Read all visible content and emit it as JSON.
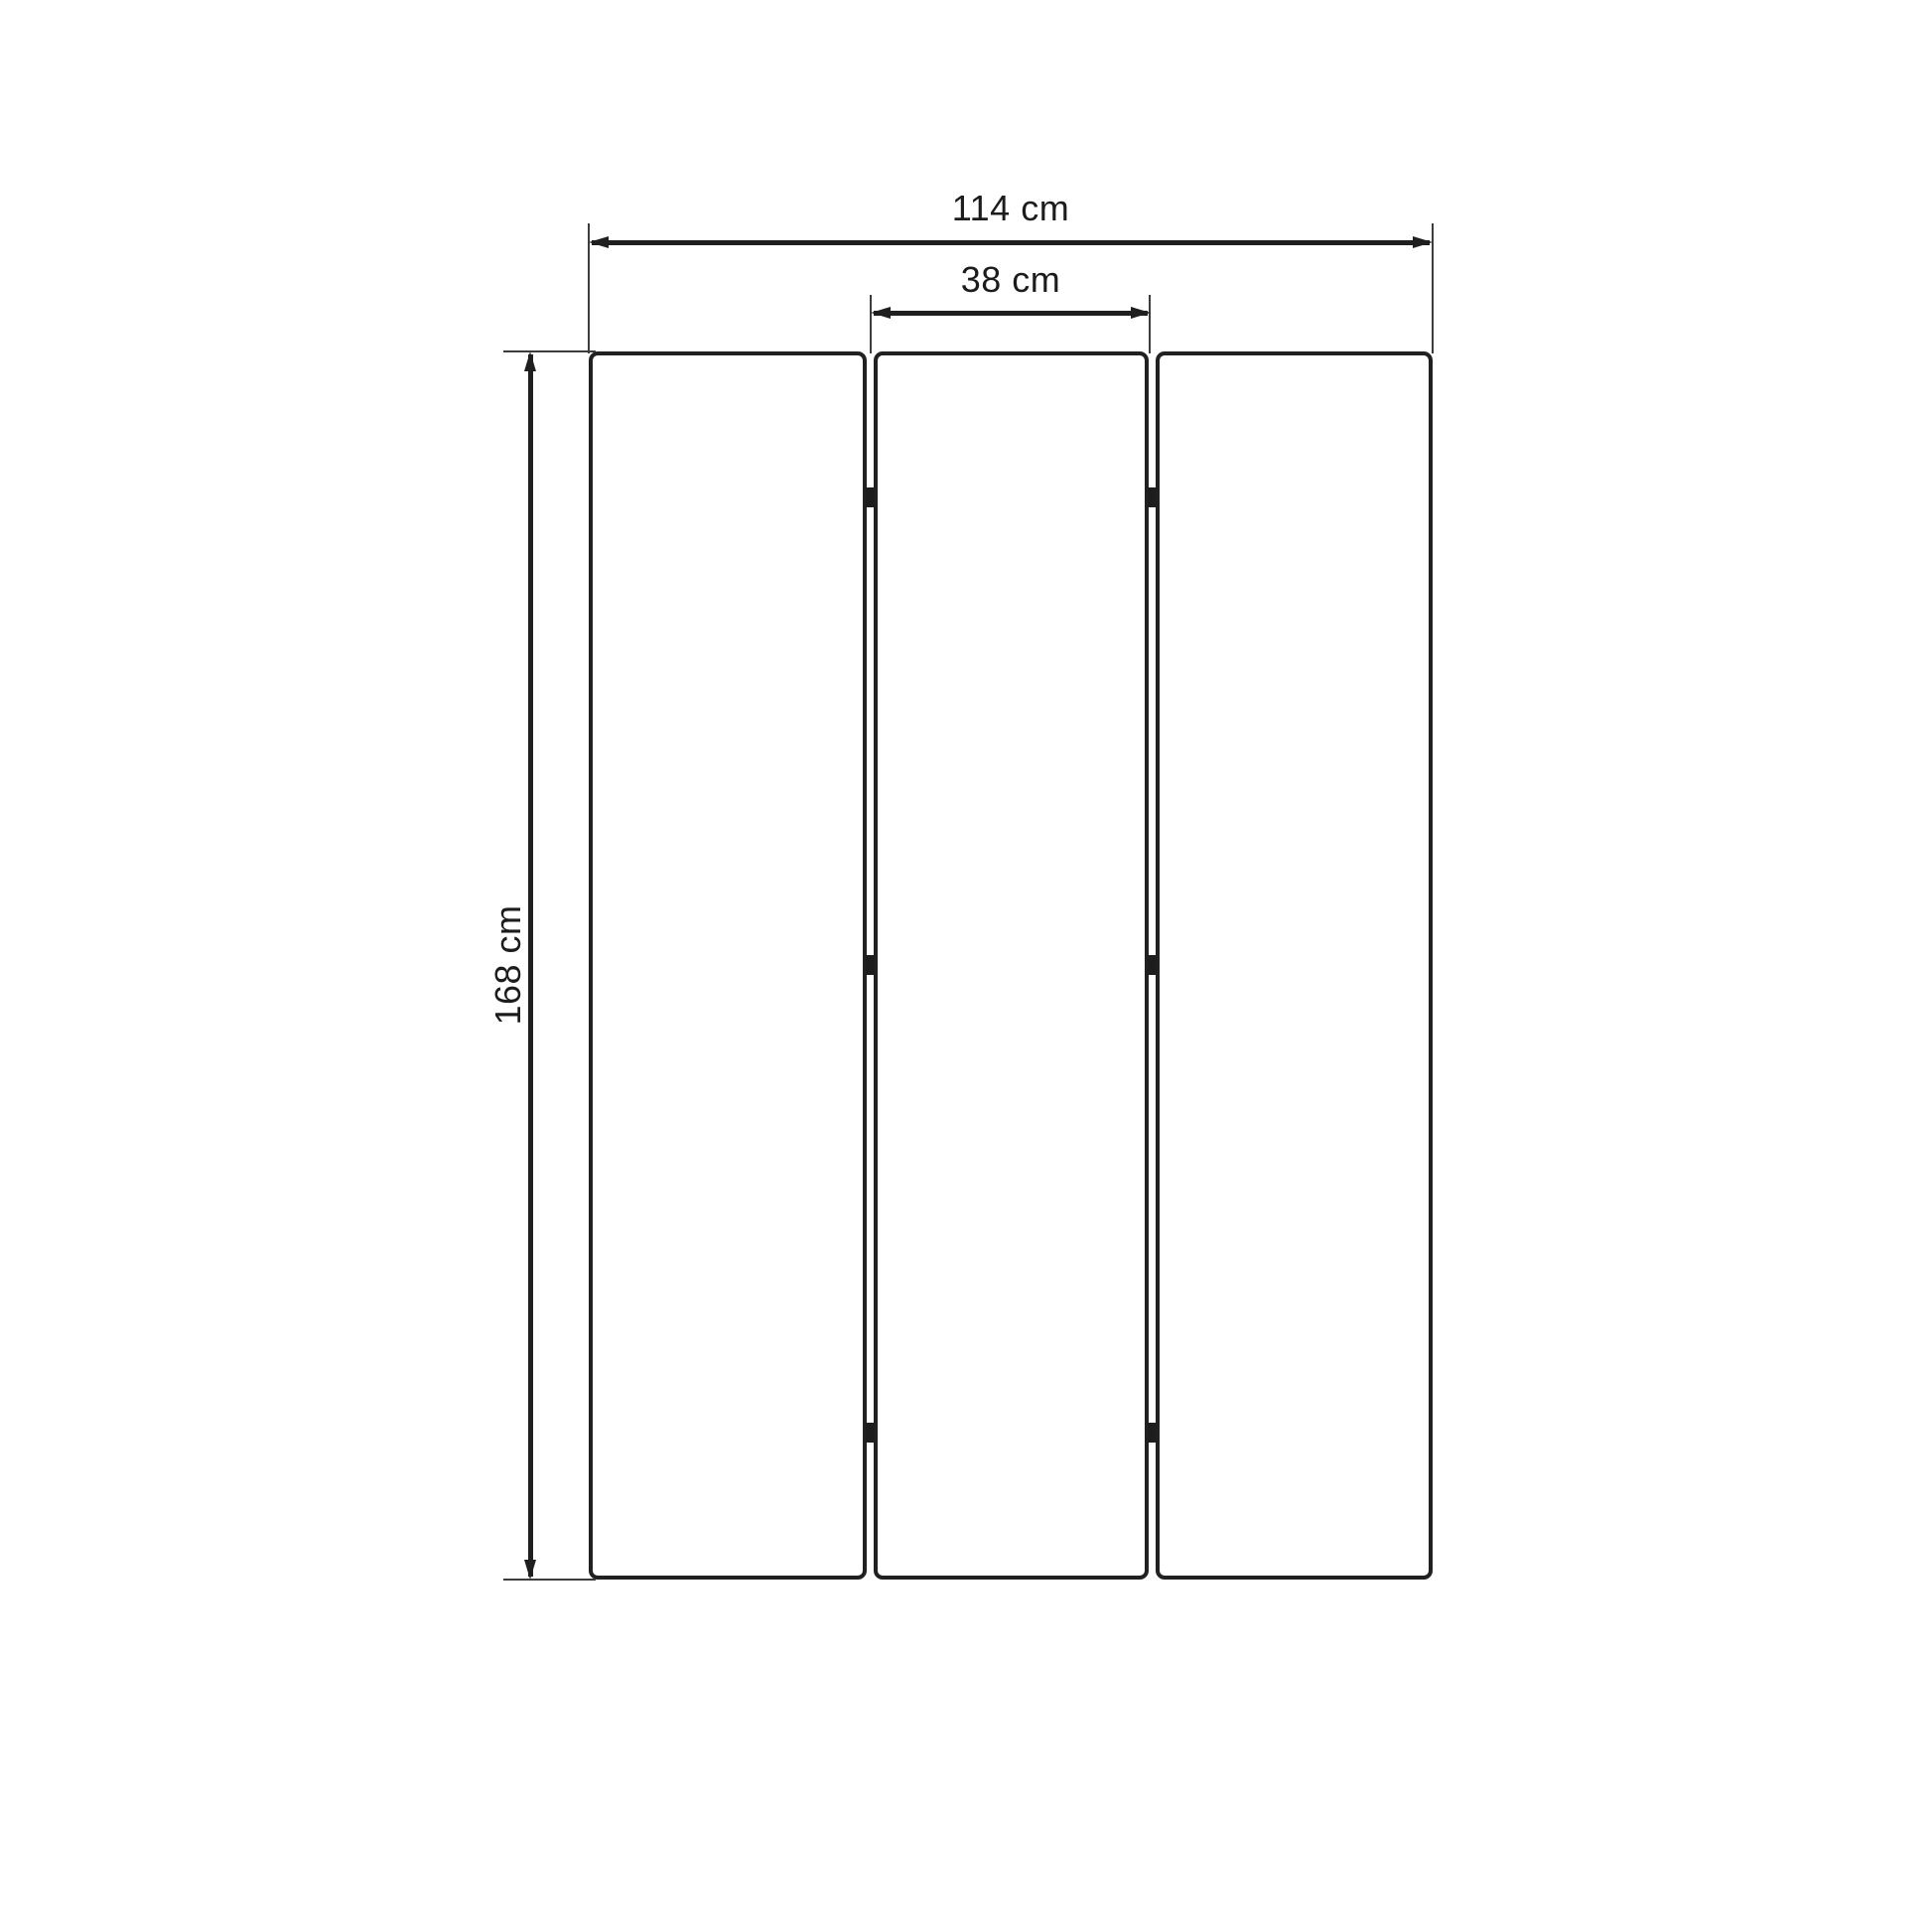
{
  "page": {
    "background": "#ffffff"
  },
  "diagram": {
    "type": "dimension-drawing",
    "subject": "three-panel folding screen front view",
    "line_color": "#1f1f1f",
    "panel_border_color": "#212121",
    "hinge_color": "#1d1d1d",
    "labels": {
      "total_width": "114 cm",
      "panel_width": "38 cm",
      "height": "168 cm"
    },
    "panels": {
      "count": 3,
      "hinge_rows_per_gap": 3
    }
  }
}
